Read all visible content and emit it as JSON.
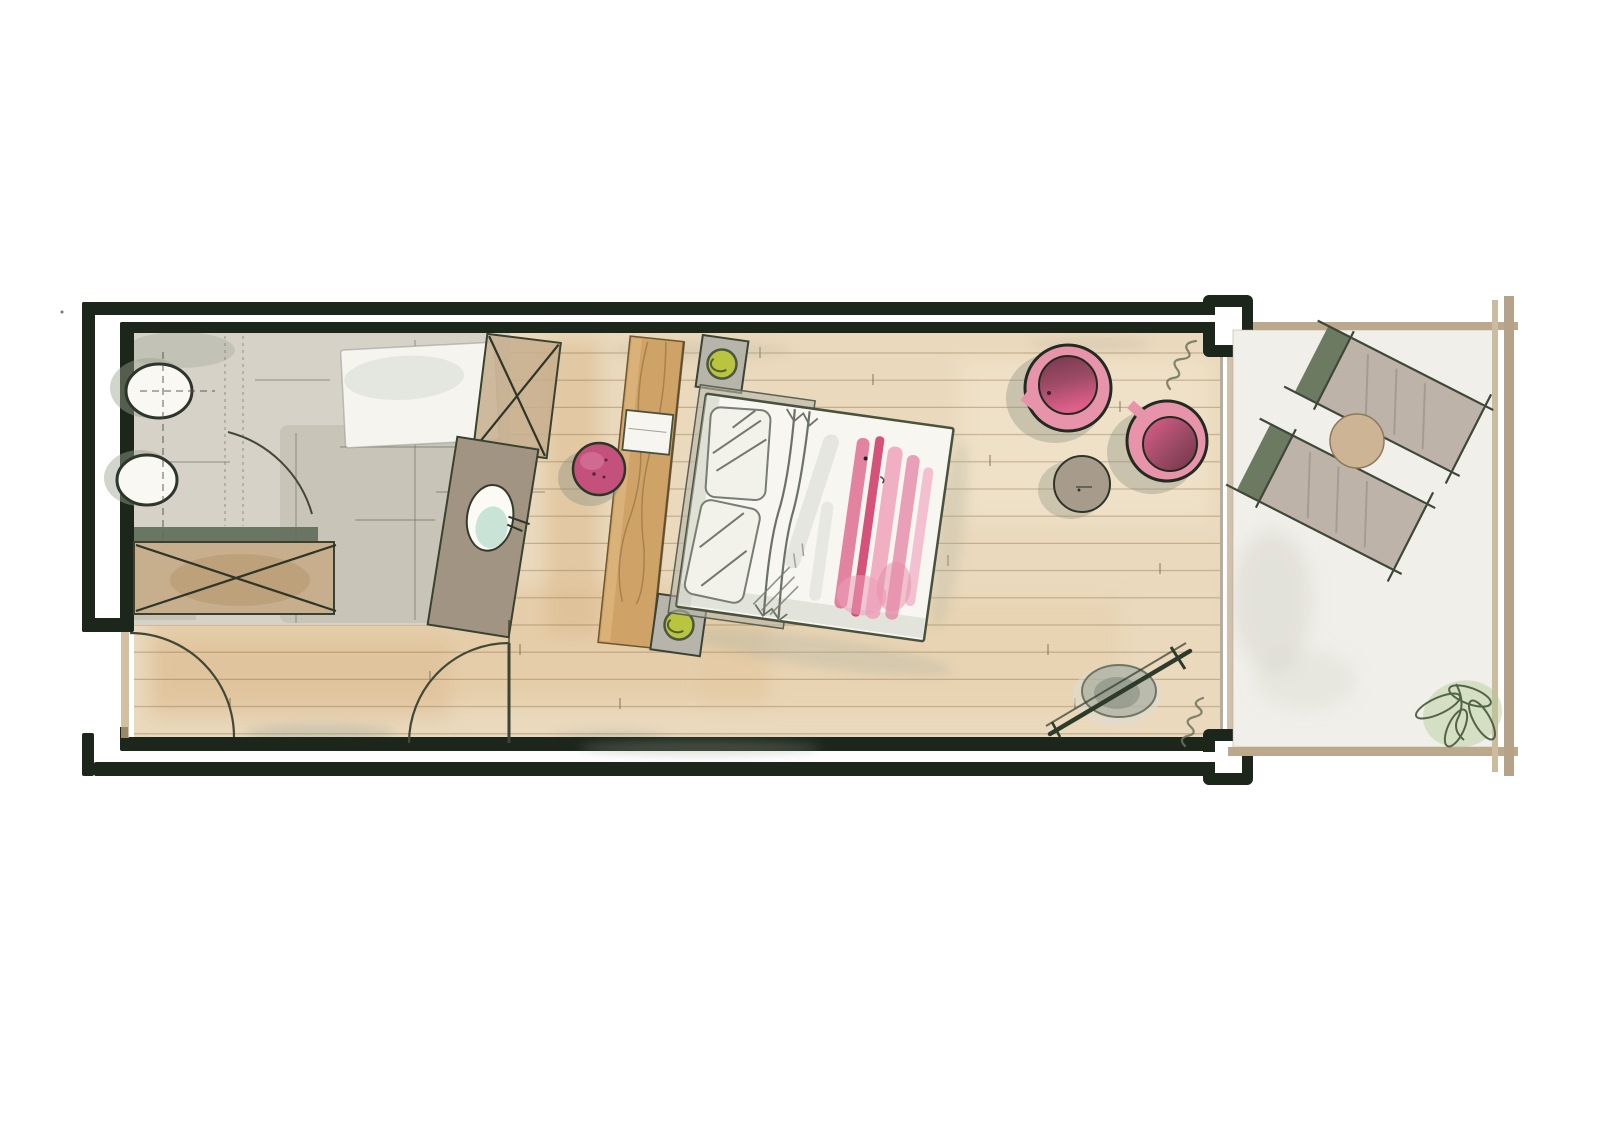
{
  "document": {
    "kind": "hand-drawn watercolor floor plan",
    "description": "Elongated hotel-suite plan: bathroom at left, entrance hallway along bottom, bedroom with angled bed in the middle, sitting corner with two round armchairs, and a terrace with two sun loungers at right"
  },
  "palette": {
    "paper": "#ffffff",
    "wall": "#1d261b",
    "wood_floor": "#ead9bd",
    "plank_line": "#86673e",
    "bath_gray": "#d7d2c8",
    "bath_gray_dark": "#c6c0b4",
    "counter_sage": "#5e6c59",
    "cabinet_tan": "#c7ae8d",
    "vanity_taupe": "#a29482",
    "sink_teal": "#bfdfd1",
    "tub_white": "#f5f4ef",
    "headboard_wood": "#cfa267",
    "bed_white": "#f7f6f1",
    "throw_pink": "#d9537f",
    "stool_magenta": "#c4517c",
    "chair_pink": "#e794aa",
    "chair_seat_dark": "#74394b",
    "lamp_green": "#b9c43f",
    "nightstand_gray": "#b7b5aa",
    "table_taupe": "#a79c8c",
    "terrace_floor": "#f0efe9",
    "terrace_border": "#bca98d",
    "lounger_body": "#b4a89d",
    "lounger_head": "#64735a",
    "terrace_table": "#cdb495",
    "plant_green": "#44583a",
    "arc_stroke": "#414936"
  },
  "rooms": [
    {
      "id": "bathroom",
      "label": "bathroom",
      "fixtures": [
        "wall-hung toilet",
        "bidet",
        "bathtub",
        "shower with X mark",
        "tilted vanity with teal washbasin",
        "counter",
        "cabinet with X mark"
      ]
    },
    {
      "id": "hallway",
      "label": "entrance hallway",
      "fixtures": [
        "entrance door with swing arc",
        "interior door with swing arc"
      ]
    },
    {
      "id": "bedroom",
      "label": "bedroom",
      "fixtures": [
        "wood headboard panel with shelf",
        "angled double bed with pillows and pink throw",
        "two nightstands with green lamps",
        "magenta stool",
        "two round pink armchairs",
        "round side table",
        "floor lamp",
        "curtain squiggles"
      ]
    },
    {
      "id": "terrace",
      "label": "terrace",
      "fixtures": [
        "two sun loungers",
        "round terrace table",
        "corner plant"
      ]
    }
  ],
  "counts": {
    "armchairs": 2,
    "sun_loungers": 2,
    "nightstands": 2,
    "door_arcs": 3,
    "window_columns": 2
  }
}
